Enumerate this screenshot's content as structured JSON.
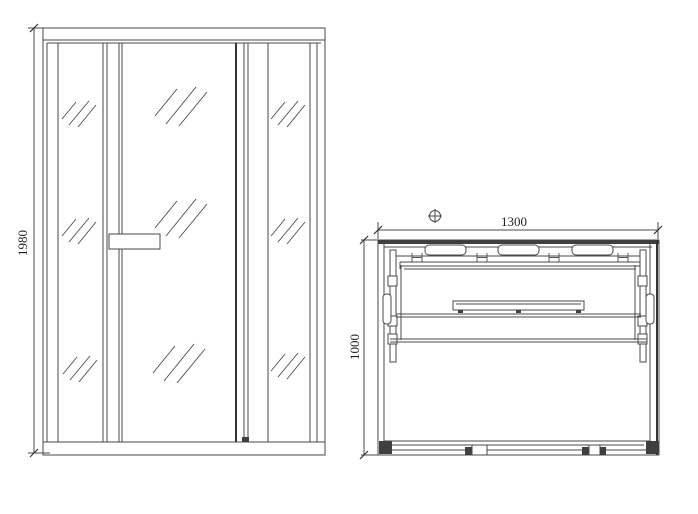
{
  "drawing": {
    "kind": "technical line drawing, sauna cabin, two orthographic views"
  },
  "front_view": {
    "view": "front elevation",
    "height_label": "1980"
  },
  "plan_view": {
    "view": "top plan",
    "width_label": "1300",
    "depth_label": "1000"
  },
  "colors": {
    "line": "#4a4a4a",
    "background": "#ffffff"
  }
}
